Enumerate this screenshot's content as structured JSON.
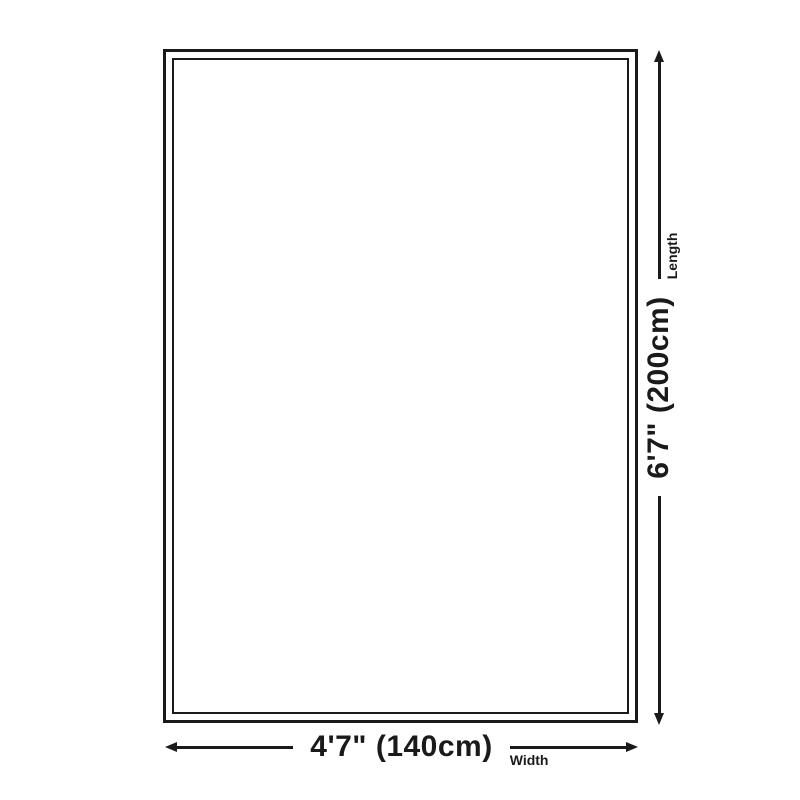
{
  "diagram": {
    "name": "rug-size-diagram",
    "width": {
      "value": "4'7\" (140cm)",
      "label": "Width"
    },
    "length": {
      "value": "6'7\" (200cm)",
      "label": "Length"
    }
  },
  "colors": {
    "ink": "#1a1a1a",
    "background": "#ffffff"
  }
}
